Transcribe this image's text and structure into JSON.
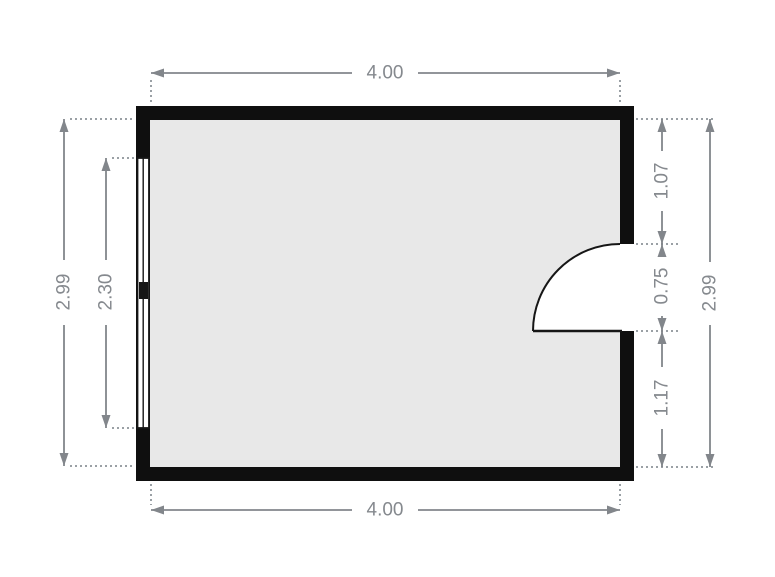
{
  "floorplan": {
    "type": "single-room floor plan",
    "dimensions": {
      "top_width": "4.00",
      "bottom_width": "4.00",
      "left_total_height": "2.99",
      "window_length": "2.30",
      "door_top_offset": "1.07",
      "door_opening_width": "0.75",
      "door_bottom_offset": "1.17",
      "right_total_height": "2.99"
    },
    "colors": {
      "background": "#ffffff",
      "wall": "#0f0f0f",
      "floor": "#e8e8e8",
      "fixture_outline": "#161616",
      "dimension_line": "#82868b",
      "extension_line": "#9aa0a5",
      "dimension_text": "#85898e"
    }
  }
}
